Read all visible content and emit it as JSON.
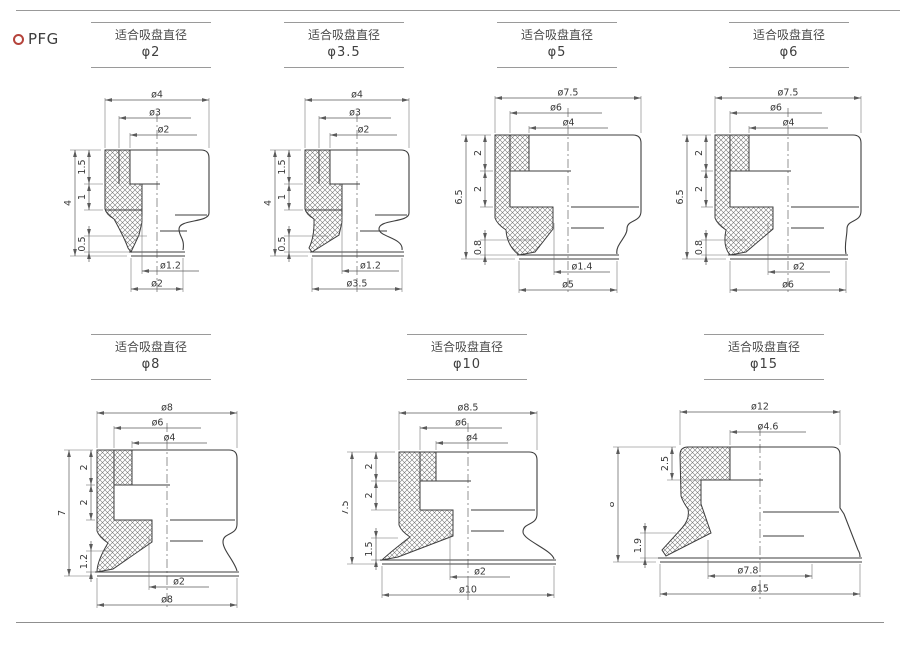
{
  "page": {
    "brand": "PFG",
    "colors": {
      "accent": "#b5433b",
      "drawing_line": "#3e3e3e",
      "dimension_line": "#5a5a5a",
      "rule": "#8f8f8f",
      "text": "#3a3a3a"
    }
  },
  "figures": [
    {
      "id": "phi2",
      "header_title": "适合吸盘直径",
      "header_value": "φ2",
      "top_dims": [
        "ø4",
        "ø3",
        "ø2"
      ],
      "overall_height": "4",
      "segment_heights": [
        "1.5",
        "1"
      ],
      "lip_height": "0.5",
      "bottom_dims": [
        "ø1.2",
        "ø2"
      ]
    },
    {
      "id": "phi3-5",
      "header_title": "适合吸盘直径",
      "header_value": "φ3.5",
      "top_dims": [
        "ø4",
        "ø3",
        "ø2"
      ],
      "overall_height": "4",
      "segment_heights": [
        "1.5",
        "1"
      ],
      "lip_height": "0.5",
      "bottom_dims": [
        "ø1.2",
        "ø3.5"
      ]
    },
    {
      "id": "phi5",
      "header_title": "适合吸盘直径",
      "header_value": "φ5",
      "top_dims": [
        "ø7.5",
        "ø6",
        "ø4"
      ],
      "overall_height": "6.5",
      "segment_heights": [
        "2",
        "2"
      ],
      "lip_height": "0.8",
      "bottom_dims": [
        "ø1.4",
        "ø5"
      ]
    },
    {
      "id": "phi6",
      "header_title": "适合吸盘直径",
      "header_value": "φ6",
      "top_dims": [
        "ø7.5",
        "ø6",
        "ø4"
      ],
      "overall_height": "6.5",
      "segment_heights": [
        "2",
        "2"
      ],
      "lip_height": "0.8",
      "bottom_dims": [
        "ø2",
        "ø6"
      ]
    },
    {
      "id": "phi8",
      "header_title": "适合吸盘直径",
      "header_value": "φ8",
      "top_dims": [
        "ø8",
        "ø6",
        "ø4"
      ],
      "overall_height": "7",
      "segment_heights": [
        "2",
        "2"
      ],
      "lip_height": "1.2",
      "bottom_dims": [
        "ø2",
        "ø8"
      ]
    },
    {
      "id": "phi10",
      "header_title": "适合吸盘直径",
      "header_value": "φ10",
      "top_dims": [
        "ø8.5",
        "ø6",
        "ø4"
      ],
      "overall_height": "7.5",
      "segment_heights": [
        "2",
        "2"
      ],
      "lip_height": "1.5",
      "bottom_dims": [
        "ø2",
        "ø10"
      ]
    },
    {
      "id": "phi15",
      "header_title": "适合吸盘直径",
      "header_value": "φ15",
      "top_dims": [
        "ø12",
        "ø4.6"
      ],
      "overall_height": "8",
      "segment_heights": [
        "2.5"
      ],
      "lip_height": "1.9",
      "bottom_dims": [
        "ø7.8",
        "ø15"
      ]
    }
  ]
}
